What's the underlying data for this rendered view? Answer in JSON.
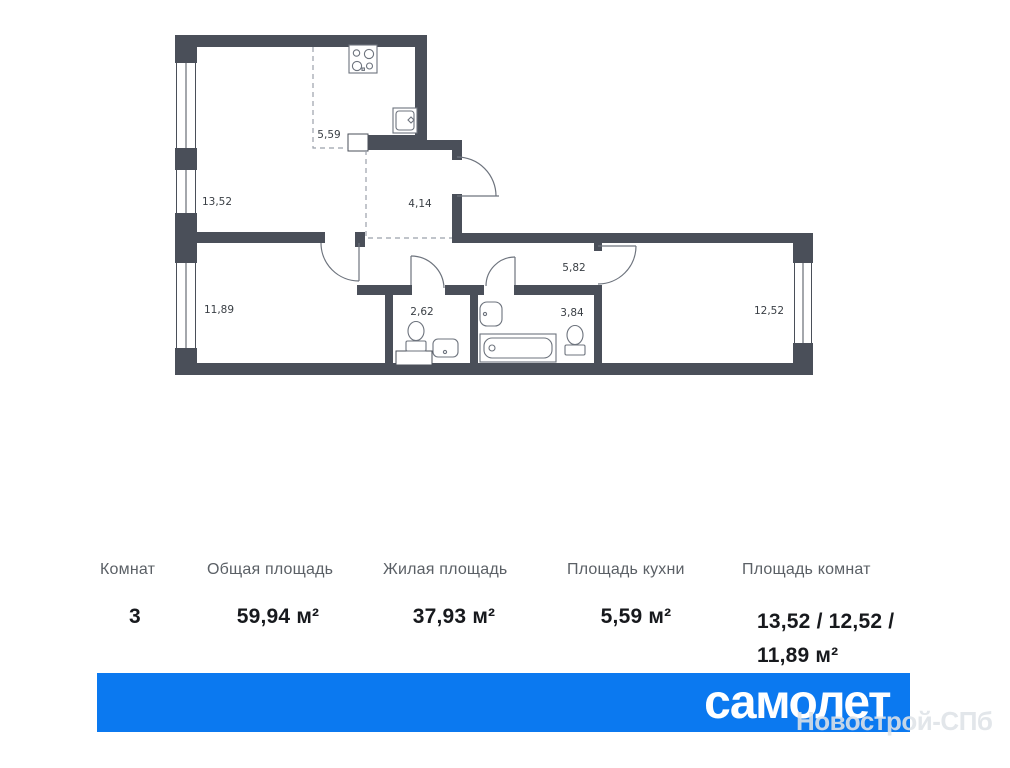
{
  "plan": {
    "room_labels": [
      {
        "name": "kitchen-zone",
        "value": "5,59"
      },
      {
        "name": "living-room",
        "value": "13,52"
      },
      {
        "name": "hallway",
        "value": "4,14"
      },
      {
        "name": "bedroom-left",
        "value": "11,89"
      },
      {
        "name": "wc",
        "value": "2,62"
      },
      {
        "name": "corridor",
        "value": "5,82"
      },
      {
        "name": "bathroom",
        "value": "3,84"
      },
      {
        "name": "bedroom-right",
        "value": "12,52"
      }
    ]
  },
  "table": {
    "columns": [
      {
        "header": "Комнат",
        "value": "3"
      },
      {
        "header": "Общая площадь",
        "value": "59,94 м²"
      },
      {
        "header": "Жилая площадь",
        "value": "37,93 м²"
      },
      {
        "header": "Площадь кухни",
        "value": "5,59 м²"
      },
      {
        "header": "Площадь комнат",
        "value": "13,52 / 12,52 / 11,89 м²"
      }
    ]
  },
  "banner": {
    "logo_text": "самолет"
  },
  "watermark": {
    "text": "Новострой-СПб"
  },
  "colors": {
    "banner_blue": "#0b79f0",
    "wall": "#4a4f59"
  }
}
